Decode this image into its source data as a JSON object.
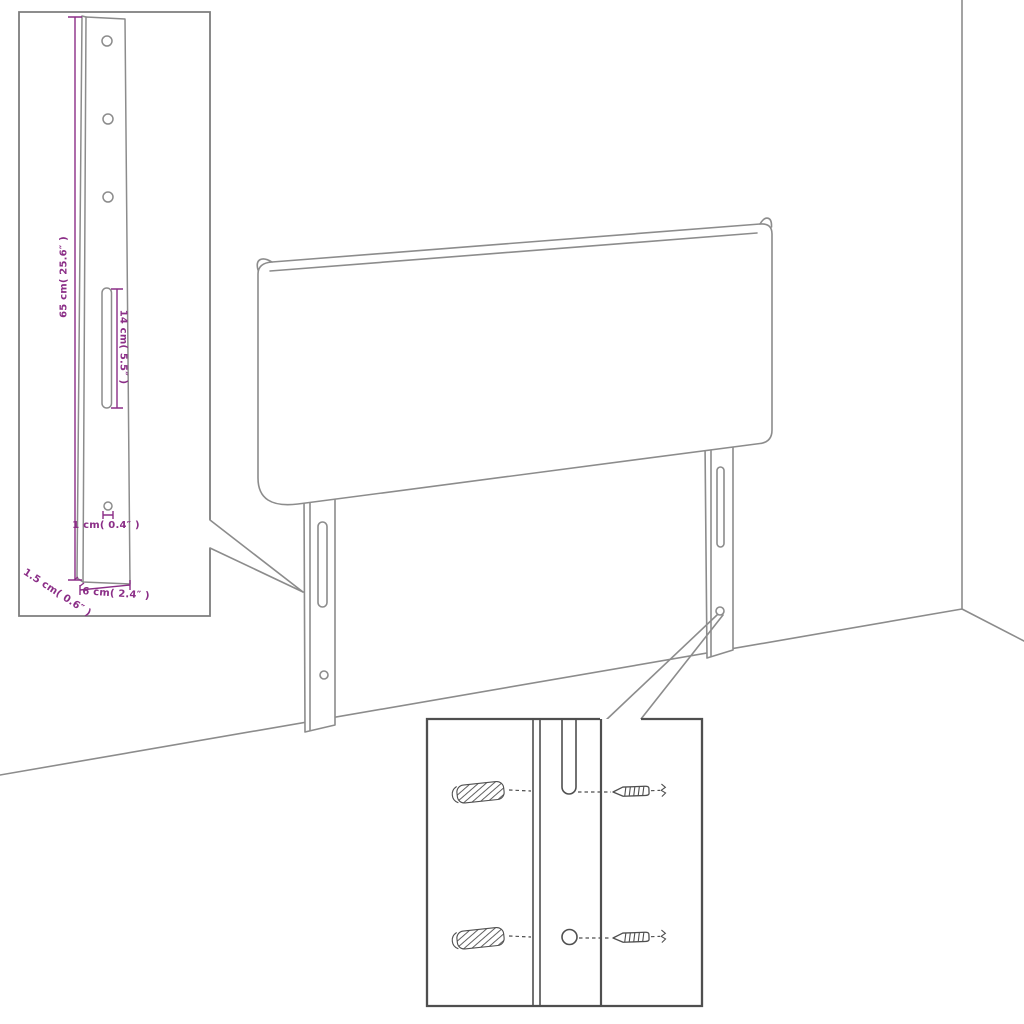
{
  "colors": {
    "background": "#ffffff",
    "artwork_line": "#8c8c8c",
    "detail_line": "#4f4f4f",
    "dimension_accent": "#8b2e87"
  },
  "inset": {
    "labels": {
      "height": "65 cm( 25.6″ )",
      "slot": "14 cm( 5.5″ )",
      "hole": "1 cm( 0.4″ )",
      "thickness": "1.5 cm( 0.6″ )",
      "width": "6 cm( 2.4″ )"
    }
  }
}
